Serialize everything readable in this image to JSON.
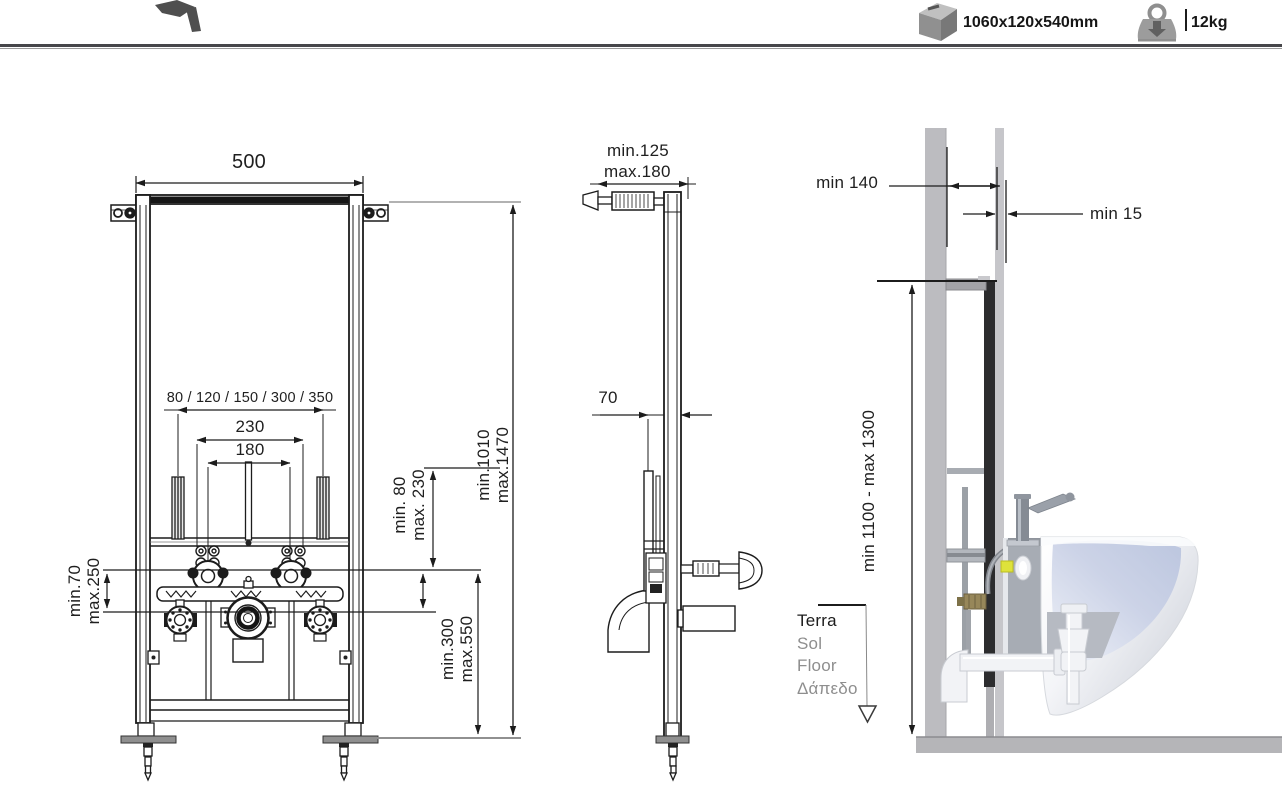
{
  "header": {
    "package_size": "1060x120x540mm",
    "weight": "12kg"
  },
  "front_view": {
    "width": "500",
    "stud_spacing_options": "80 / 120 / 150 / 300 / 350",
    "bolt_spacing": "230",
    "fixing_spacing": "180",
    "height_min": "min.1010",
    "height_max": "max.1470",
    "fixing_height_min": "min. 80",
    "fixing_height_max": "max. 230",
    "supply_min": "min.70",
    "supply_max": "max.250",
    "drain_min": "min.300",
    "drain_max": "max.550"
  },
  "side_view": {
    "depth_min": "min.125",
    "depth_max": "max.180",
    "profile_depth": "70"
  },
  "install_view": {
    "wall_distance": "min 140",
    "panel_thickness": "min 15",
    "mount_height": "min 1100 - max 1300",
    "floor_labels": [
      "Terra",
      "Sol",
      "Floor",
      "Δάπεδο"
    ]
  },
  "colors": {
    "line": "#1c1c1c",
    "wall_gray": "#bcbcc0",
    "floor_gray": "#b5b5b8",
    "frame_dark": "#2c2c2e",
    "yellow_fitting": "#dee23b",
    "brass": "#97875a"
  }
}
